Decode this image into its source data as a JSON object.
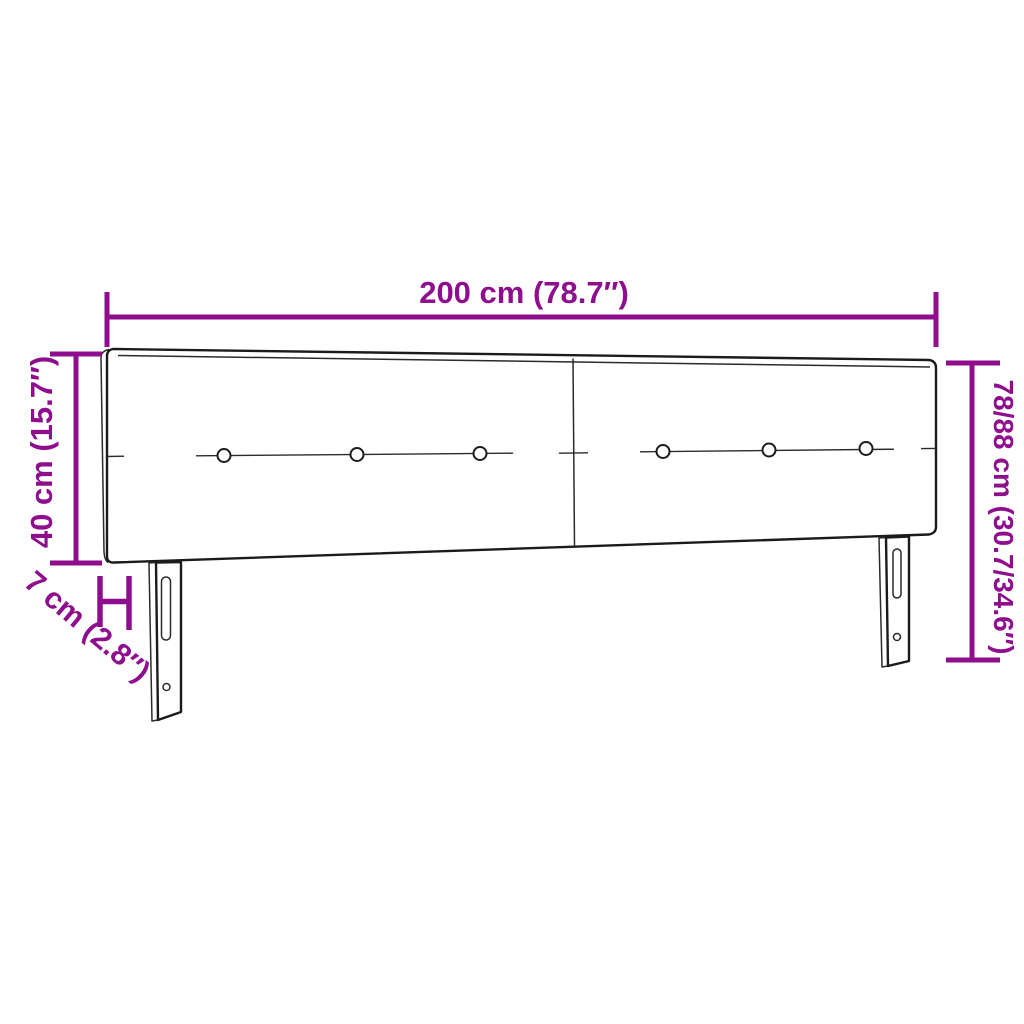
{
  "labels": {
    "width": "200 cm (78.7″)",
    "board_height": "40 cm (15.7″)",
    "depth": "7 cm (2.8″)",
    "total_height": "78/88 cm (30.7/34.6″)"
  },
  "colors": {
    "dimension_annotation": "#8E0E8E",
    "drawing_outline": "#1B1B1B",
    "background": "#FFFFFF"
  }
}
